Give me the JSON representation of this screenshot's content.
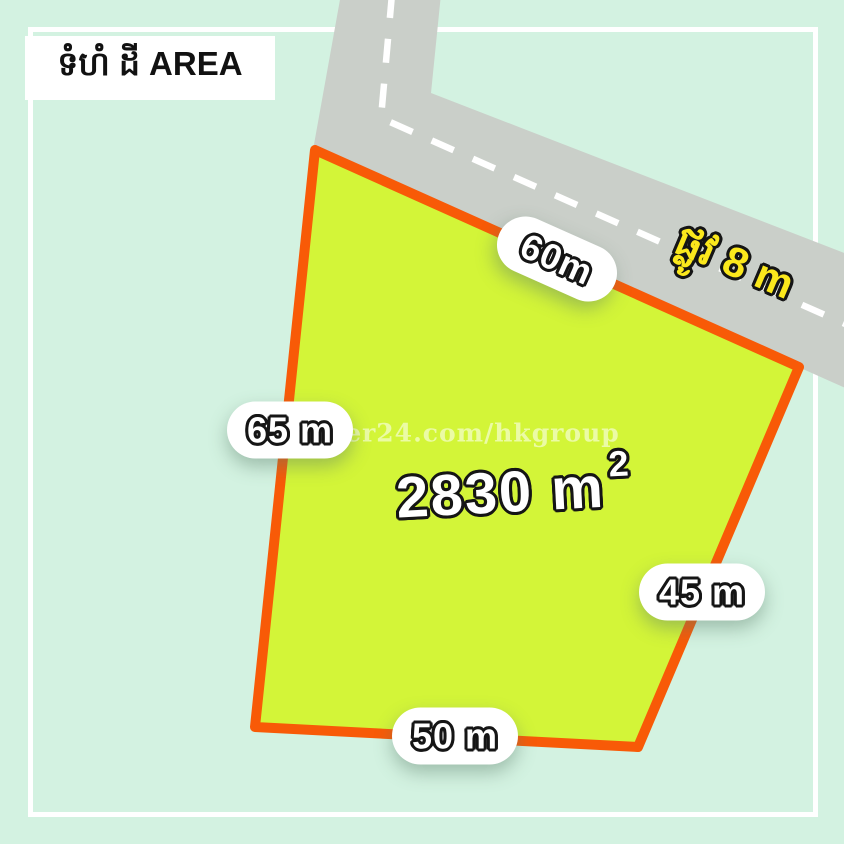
{
  "canvas": {
    "width": 844,
    "height": 844
  },
  "colors": {
    "background": "#d3f2e1",
    "frame": "#ffffff",
    "road": "#cacfc9",
    "road_dash": "#ffffff",
    "plot_fill": "#d3f538",
    "plot_border": "#f85a07",
    "pill_background": "#ffffff",
    "dimension_text": "#ffffff",
    "text_outline": "#151515",
    "road_label_color": "#fbe81c",
    "title_color": "#111111",
    "watermark_color": "rgba(255,255,255,0.55)"
  },
  "title": {
    "text": "ទំហំ ដី AREA"
  },
  "watermark": {
    "text": "khmer24.com/hkgroup"
  },
  "area_label": {
    "value": "2830 m",
    "exponent": "2",
    "area_m2": 2830
  },
  "road_label": {
    "text": "ផ្លូវ 8 m",
    "road_width_m": 8
  },
  "dimensions": [
    {
      "side": "top",
      "label": "60m",
      "meters": 60
    },
    {
      "side": "left",
      "label": "65 m",
      "meters": 65
    },
    {
      "side": "right",
      "label": "45 m",
      "meters": 45
    },
    {
      "side": "bottom",
      "label": "50 m",
      "meters": 50
    }
  ]
}
